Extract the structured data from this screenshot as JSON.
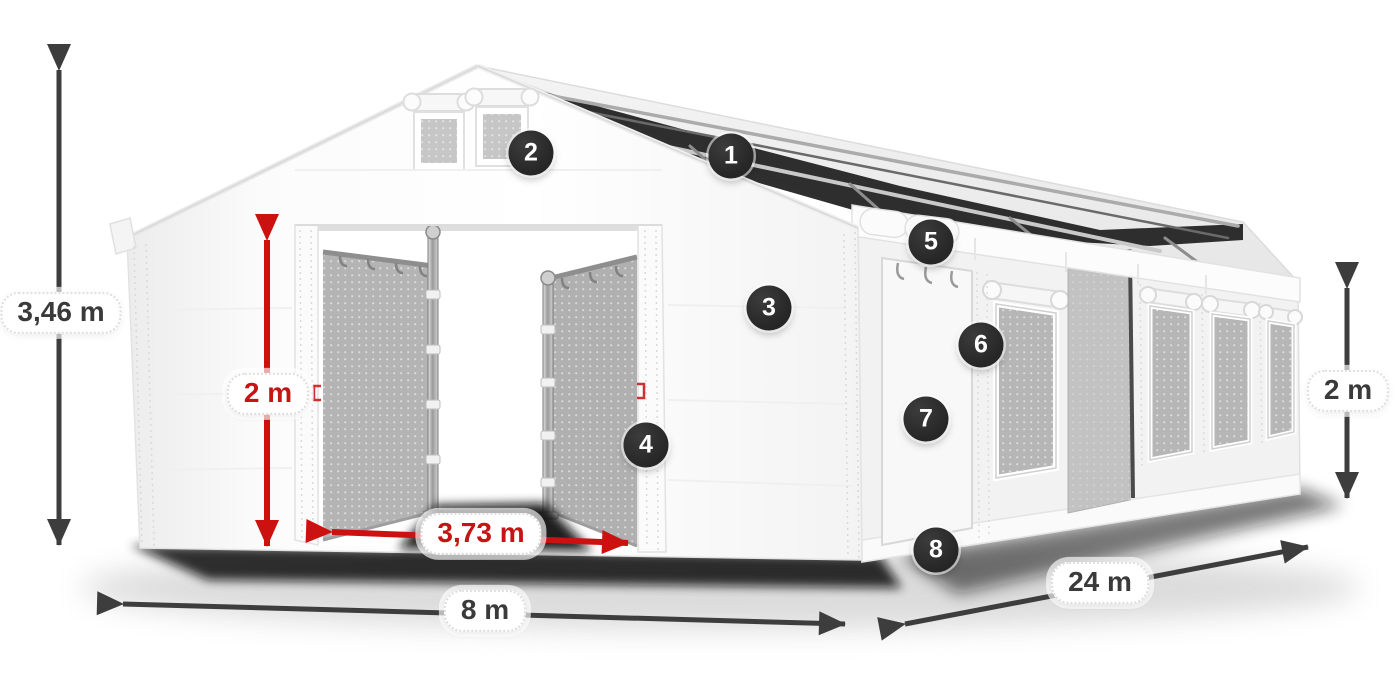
{
  "diagram_title": "Storage tent with dimension callouts",
  "colors": {
    "background": "#ffffff",
    "arrow_dark": "#3d3d3d",
    "arrow_red": "#cc1111",
    "pill_text_dark": "#3a3a3a",
    "pill_text_red": "#c41414",
    "badge_bg": "#2d2d2d",
    "badge_text": "#ffffff",
    "tent_white": "#f8f8f8",
    "mesh_gray": "#b6b6b6",
    "roof_dark": "#1d1d1d"
  },
  "measurements": {
    "total_height": {
      "label": "3,46 m",
      "color": "dark",
      "meaning": "overall tent height"
    },
    "door_height": {
      "label": "2 m",
      "color": "red",
      "meaning": "entrance clearance height"
    },
    "door_width": {
      "label": "3,73 m",
      "color": "red",
      "meaning": "entrance clearance width"
    },
    "width": {
      "label": "8 m",
      "color": "dark",
      "meaning": "tent gable width"
    },
    "length": {
      "label": "24 m",
      "color": "dark",
      "meaning": "tent side length"
    },
    "side_height": {
      "label": "2 m",
      "color": "dark",
      "meaning": "side wall height"
    }
  },
  "badges": [
    {
      "label": "1"
    },
    {
      "label": "2"
    },
    {
      "label": "3"
    },
    {
      "label": "4"
    },
    {
      "label": "5"
    },
    {
      "label": "6"
    },
    {
      "label": "7"
    },
    {
      "label": "8"
    }
  ]
}
